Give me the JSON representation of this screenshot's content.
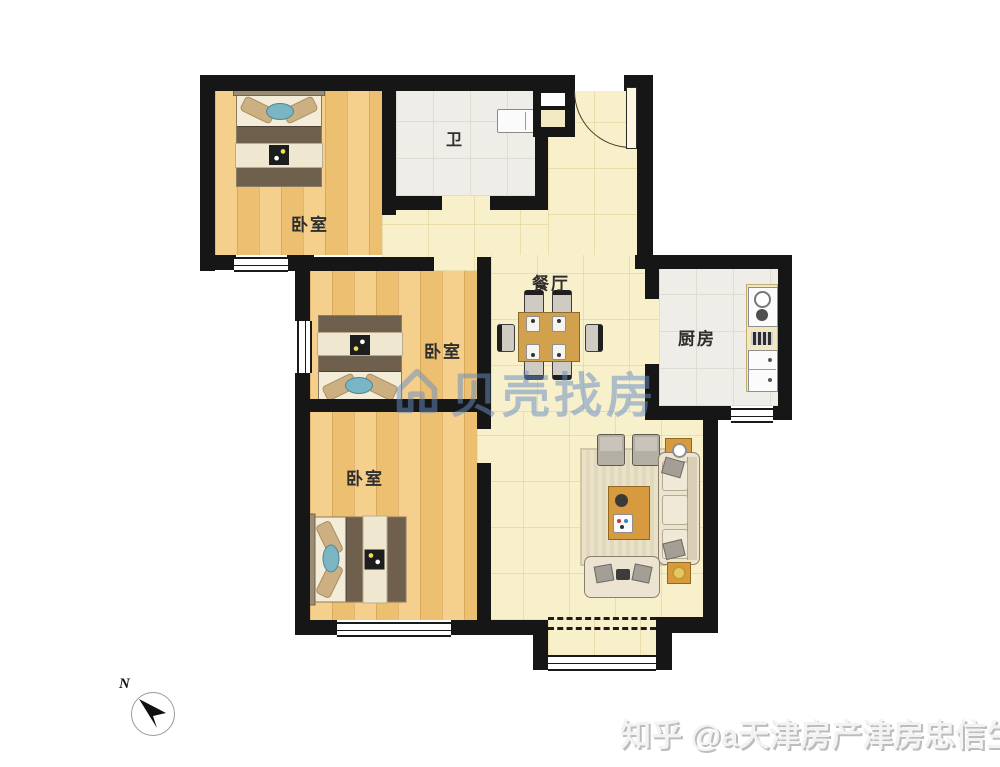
{
  "floor_plan": {
    "room_labels": {
      "bedroom_top": "卧室",
      "bedroom_middle": "卧室",
      "bedroom_bottom": "卧室",
      "bathroom": "卫",
      "dining": "餐厅",
      "kitchen": "厨房"
    },
    "compass_north": "N",
    "colors": {
      "wall": "#161616",
      "wood_floor": "#f2c87e",
      "ceramic_floor": "#efede8",
      "hall_floor": "#f8f0ca",
      "furniture_wood": "#d79a3f",
      "watermark_blue": "#6c94c6"
    }
  },
  "watermarks": {
    "brand": "贝壳找房",
    "credit": "知乎 @a天津房产津房忠信生"
  }
}
